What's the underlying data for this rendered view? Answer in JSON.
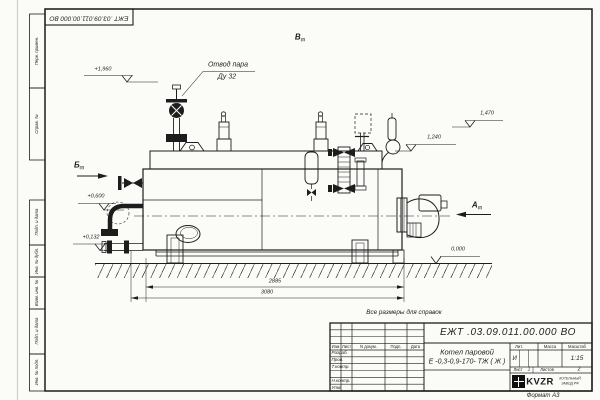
{
  "frame": {
    "top_stamp": "ЕЖТ .03.09.011.00.000  ВО",
    "side_labels": [
      "Перв. примен.",
      "Справ. №",
      "Подп. и дата",
      "Инв. № дубл.",
      "Взам. инв. №",
      "Подп. и дата",
      "Инв. № подл."
    ],
    "format_note": "Формат А3"
  },
  "drawing": {
    "callout": {
      "line1": "Отвод пара",
      "line2": "Ду 32"
    },
    "views": {
      "left": "Б",
      "left_ref": "(2)",
      "top": "В",
      "top_ref": "(2)",
      "right": "А",
      "right_ref": "(2)"
    },
    "elevations": {
      "top_left": "+1,960",
      "top_right": "1,470",
      "mid_right": "1,240",
      "mid_left": "+0,600",
      "low_left": "+0,132",
      "ground": "0,000"
    },
    "dimensions": {
      "length_inner": "2885",
      "length_overall": "3080"
    },
    "reference_note": "Все размеры для справок"
  },
  "title_block": {
    "doc_number": "ЕЖТ .03.09.011.00.000  ВО",
    "product_line1": "Котел паровой",
    "product_line2": "Е -0,3-0,9-170- ТЖ ( Ж )",
    "col_headers": {
      "izm": "Изм",
      "list": "Лист",
      "doc": "N докум.",
      "podp": "Подп.",
      "data": "Дата"
    },
    "row_labels": {
      "r1": "Разраб.",
      "r2": "Пров.",
      "r3": "Т.контр.",
      "r5": "Н.контр.",
      "r6": "Утв."
    },
    "right_headers": {
      "lit": "Лит.",
      "mass": "Масса",
      "scale": "Масштаб"
    },
    "values": {
      "lit": "И",
      "scale": "1:15"
    },
    "sheet": {
      "list_label": "Лист",
      "list_value": "1",
      "listov_label": "Листов",
      "listov_value": "2"
    },
    "logo": {
      "brand": "KVZR",
      "sub1": "КОТЕЛЬНЫЙ",
      "sub2": "ЗАВОД РФ"
    }
  }
}
